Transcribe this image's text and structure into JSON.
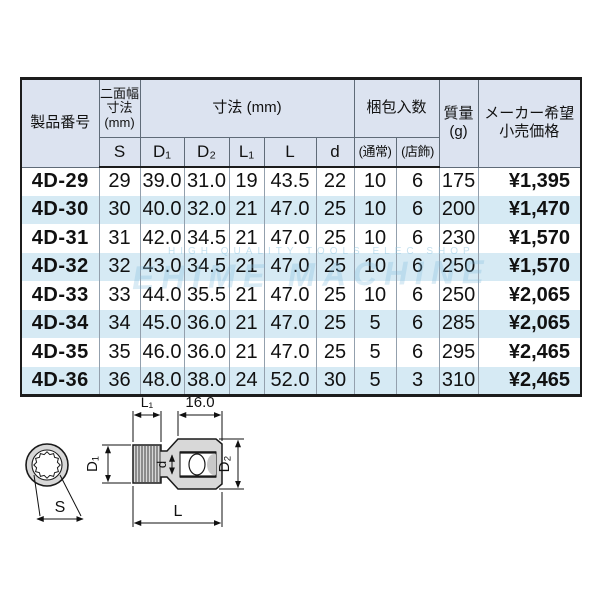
{
  "watermark": {
    "small_text": "HIGH QUALITY TOOLS ELEC SHOP",
    "large_text": "EHIME MACHINE",
    "color": "#8abede"
  },
  "table": {
    "header": {
      "product_no": "製品番号",
      "two_face_width_lines": [
        "二面幅",
        "寸法",
        "(mm)"
      ],
      "dimensions_label": "寸法 (mm)",
      "packing_label": "梱包入数",
      "mass_lines": [
        "質量",
        "(g)"
      ],
      "price_lines": [
        "メーカー希望",
        "小売価格"
      ],
      "sub_headers": [
        "S",
        "D₁",
        "D₂",
        "L₁",
        "L",
        "d",
        "(通常)",
        "(店飾)"
      ]
    },
    "rows": [
      {
        "product_no": "4D-29",
        "values": [
          "29",
          "39.0",
          "31.0",
          "19",
          "43.5",
          "22",
          "10",
          "6",
          "175"
        ],
        "price": "¥1,395"
      },
      {
        "product_no": "4D-30",
        "values": [
          "30",
          "40.0",
          "32.0",
          "21",
          "47.0",
          "25",
          "10",
          "6",
          "200"
        ],
        "price": "¥1,470"
      },
      {
        "product_no": "4D-31",
        "values": [
          "31",
          "42.0",
          "34.5",
          "21",
          "47.0",
          "25",
          "10",
          "6",
          "230"
        ],
        "price": "¥1,570"
      },
      {
        "product_no": "4D-32",
        "values": [
          "32",
          "43.0",
          "34.5",
          "21",
          "47.0",
          "25",
          "10",
          "6",
          "250"
        ],
        "price": "¥1,570"
      },
      {
        "product_no": "4D-33",
        "values": [
          "33",
          "44.0",
          "35.5",
          "21",
          "47.0",
          "25",
          "10",
          "6",
          "250"
        ],
        "price": "¥2,065"
      },
      {
        "product_no": "4D-34",
        "values": [
          "34",
          "45.0",
          "36.0",
          "21",
          "47.0",
          "25",
          "5",
          "6",
          "285"
        ],
        "price": "¥2,065"
      },
      {
        "product_no": "4D-35",
        "values": [
          "35",
          "46.0",
          "36.0",
          "21",
          "47.0",
          "25",
          "5",
          "6",
          "295"
        ],
        "price": "¥2,465"
      },
      {
        "product_no": "4D-36",
        "values": [
          "36",
          "48.0",
          "38.0",
          "24",
          "52.0",
          "30",
          "5",
          "3",
          "310"
        ],
        "price": "¥2,465"
      }
    ],
    "colors": {
      "header_bg": "#dce3f0",
      "stripe_bg": "#d6eaf4",
      "border_dark": "#1c1c1c",
      "grid_line": "#93a0ad"
    }
  },
  "diagram": {
    "labels": {
      "s": "S",
      "d1": "D₁",
      "d2": "D₂",
      "d": "d",
      "l1": "L₁",
      "l": "L",
      "drive_width": "16.0"
    }
  }
}
